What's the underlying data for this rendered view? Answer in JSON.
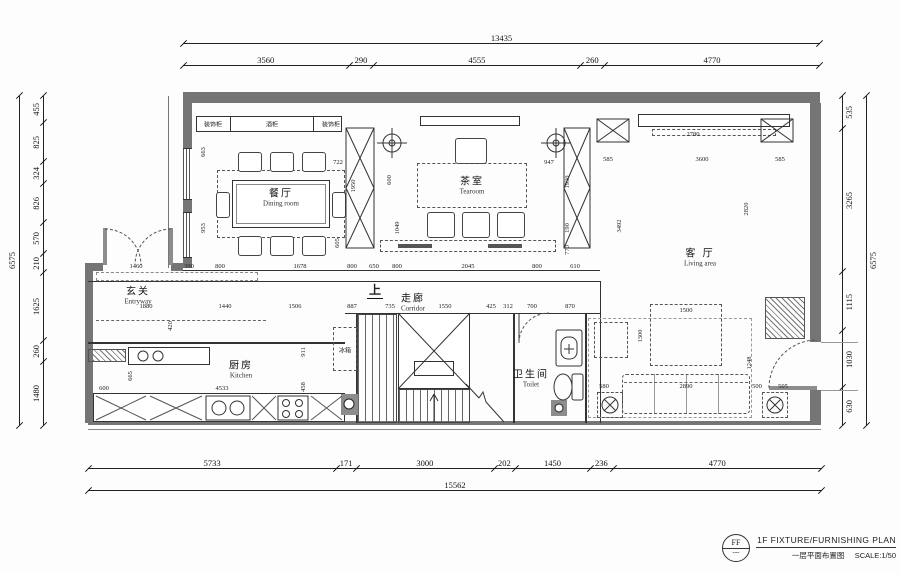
{
  "drawing": {
    "stamp": "FF",
    "stamp_sub": "---",
    "title_en": "1F FIXTURE/FURNISHING PLAN",
    "title_cn": "一层平面布置图",
    "scale_label": "SCALE:1/50"
  },
  "dimensions": {
    "top_total": [
      "13435"
    ],
    "top": [
      "3560",
      "290",
      "4555",
      "260",
      "4770"
    ],
    "bottom": [
      "5733",
      "171",
      "3000",
      "202",
      "1450",
      "236",
      "4770"
    ],
    "bottom_total": [
      "15562"
    ],
    "left_total": [
      "6575"
    ],
    "left": [
      "455",
      "825",
      "324",
      "826",
      "570",
      "210",
      "1625",
      "260",
      "1480"
    ],
    "right": [
      "535",
      "3265",
      "1115",
      "1030",
      "630"
    ],
    "right_total": [
      "6575"
    ]
  },
  "rooms": [
    {
      "id": "dining",
      "cn": "餐厅",
      "en": "Dining room",
      "x": 281,
      "y": 196
    },
    {
      "id": "tearoom",
      "cn": "茶室",
      "en": "Tearoom",
      "x": 472,
      "y": 184
    },
    {
      "id": "living",
      "cn": "客 厅",
      "en": "Living area",
      "x": 700,
      "y": 256
    },
    {
      "id": "entryway",
      "cn": "玄关",
      "en": "Entryway",
      "x": 138,
      "y": 294
    },
    {
      "id": "corridor",
      "cn": "走廊",
      "en": "Corridor",
      "x": 413,
      "y": 301
    },
    {
      "id": "kitchen",
      "cn": "厨房",
      "en": "Kitchen",
      "x": 241,
      "y": 368
    },
    {
      "id": "toilet",
      "cn": "卫生间",
      "en": "Toilet",
      "x": 531,
      "y": 377
    }
  ],
  "annotations": [
    {
      "t": "上",
      "x": 375,
      "y": 290,
      "cls": "up"
    },
    {
      "t": "冰箱",
      "x": 345,
      "y": 350,
      "cls": "tiny"
    },
    {
      "t": "装饰柜",
      "x": 213,
      "y": 124,
      "cls": "tiny"
    },
    {
      "t": "酒柜",
      "x": 272,
      "y": 124,
      "cls": "tiny"
    },
    {
      "t": "装饰柜",
      "x": 331,
      "y": 124,
      "cls": "tiny"
    }
  ],
  "interior_dims": [
    {
      "t": "1460",
      "x": 136,
      "y": 267
    },
    {
      "t": "390",
      "x": 189,
      "y": 267
    },
    {
      "t": "800",
      "x": 220,
      "y": 267
    },
    {
      "t": "1678",
      "x": 300,
      "y": 267
    },
    {
      "t": "800",
      "x": 352,
      "y": 267
    },
    {
      "t": "650",
      "x": 374,
      "y": 267
    },
    {
      "t": "800",
      "x": 397,
      "y": 267
    },
    {
      "t": "2045",
      "x": 468,
      "y": 267
    },
    {
      "t": "800",
      "x": 537,
      "y": 267
    },
    {
      "t": "610",
      "x": 575,
      "y": 267
    },
    {
      "t": "1880",
      "x": 146,
      "y": 307
    },
    {
      "t": "1440",
      "x": 225,
      "y": 307
    },
    {
      "t": "1506",
      "x": 295,
      "y": 307
    },
    {
      "t": "887",
      "x": 352,
      "y": 307
    },
    {
      "t": "735",
      "x": 390,
      "y": 307
    },
    {
      "t": "1550",
      "x": 445,
      "y": 307
    },
    {
      "t": "425",
      "x": 491,
      "y": 307
    },
    {
      "t": "312",
      "x": 508,
      "y": 307
    },
    {
      "t": "700",
      "x": 532,
      "y": 307
    },
    {
      "t": "870",
      "x": 570,
      "y": 307
    },
    {
      "t": "585",
      "x": 608,
      "y": 160
    },
    {
      "t": "3600",
      "x": 702,
      "y": 160
    },
    {
      "t": "585",
      "x": 780,
      "y": 160
    },
    {
      "t": "2780",
      "x": 693,
      "y": 135
    },
    {
      "t": "1500",
      "x": 686,
      "y": 311
    },
    {
      "t": "1300",
      "x": 641,
      "y": 336,
      "v": 1
    },
    {
      "t": "2890",
      "x": 686,
      "y": 387
    },
    {
      "t": "580",
      "x": 604,
      "y": 387
    },
    {
      "t": "500",
      "x": 757,
      "y": 387
    },
    {
      "t": "505",
      "x": 783,
      "y": 387
    },
    {
      "t": "1248",
      "x": 750,
      "y": 363,
      "v": 1
    },
    {
      "t": "3492",
      "x": 620,
      "y": 226,
      "v": 1
    },
    {
      "t": "2820",
      "x": 747,
      "y": 209,
      "v": 1
    },
    {
      "t": "722",
      "x": 338,
      "y": 163
    },
    {
      "t": "1950",
      "x": 354,
      "y": 186,
      "v": 1
    },
    {
      "t": "605",
      "x": 338,
      "y": 243,
      "v": 1
    },
    {
      "t": "663",
      "x": 204,
      "y": 152,
      "v": 1
    },
    {
      "t": "953",
      "x": 204,
      "y": 228,
      "v": 1
    },
    {
      "t": "600",
      "x": 390,
      "y": 180,
      "v": 1
    },
    {
      "t": "1049",
      "x": 398,
      "y": 228,
      "v": 1
    },
    {
      "t": "947",
      "x": 549,
      "y": 163
    },
    {
      "t": "1930",
      "x": 568,
      "y": 182,
      "v": 1
    },
    {
      "t": "190",
      "x": 568,
      "y": 228,
      "v": 1
    },
    {
      "t": "770",
      "x": 568,
      "y": 250,
      "v": 1
    },
    {
      "t": "4533",
      "x": 222,
      "y": 389
    },
    {
      "t": "600",
      "x": 104,
      "y": 389
    },
    {
      "t": "665",
      "x": 131,
      "y": 376,
      "v": 1
    },
    {
      "t": "911",
      "x": 304,
      "y": 352,
      "v": 1
    },
    {
      "t": "458",
      "x": 304,
      "y": 387,
      "v": 1
    },
    {
      "t": "420",
      "x": 171,
      "y": 326,
      "v": 1
    }
  ]
}
